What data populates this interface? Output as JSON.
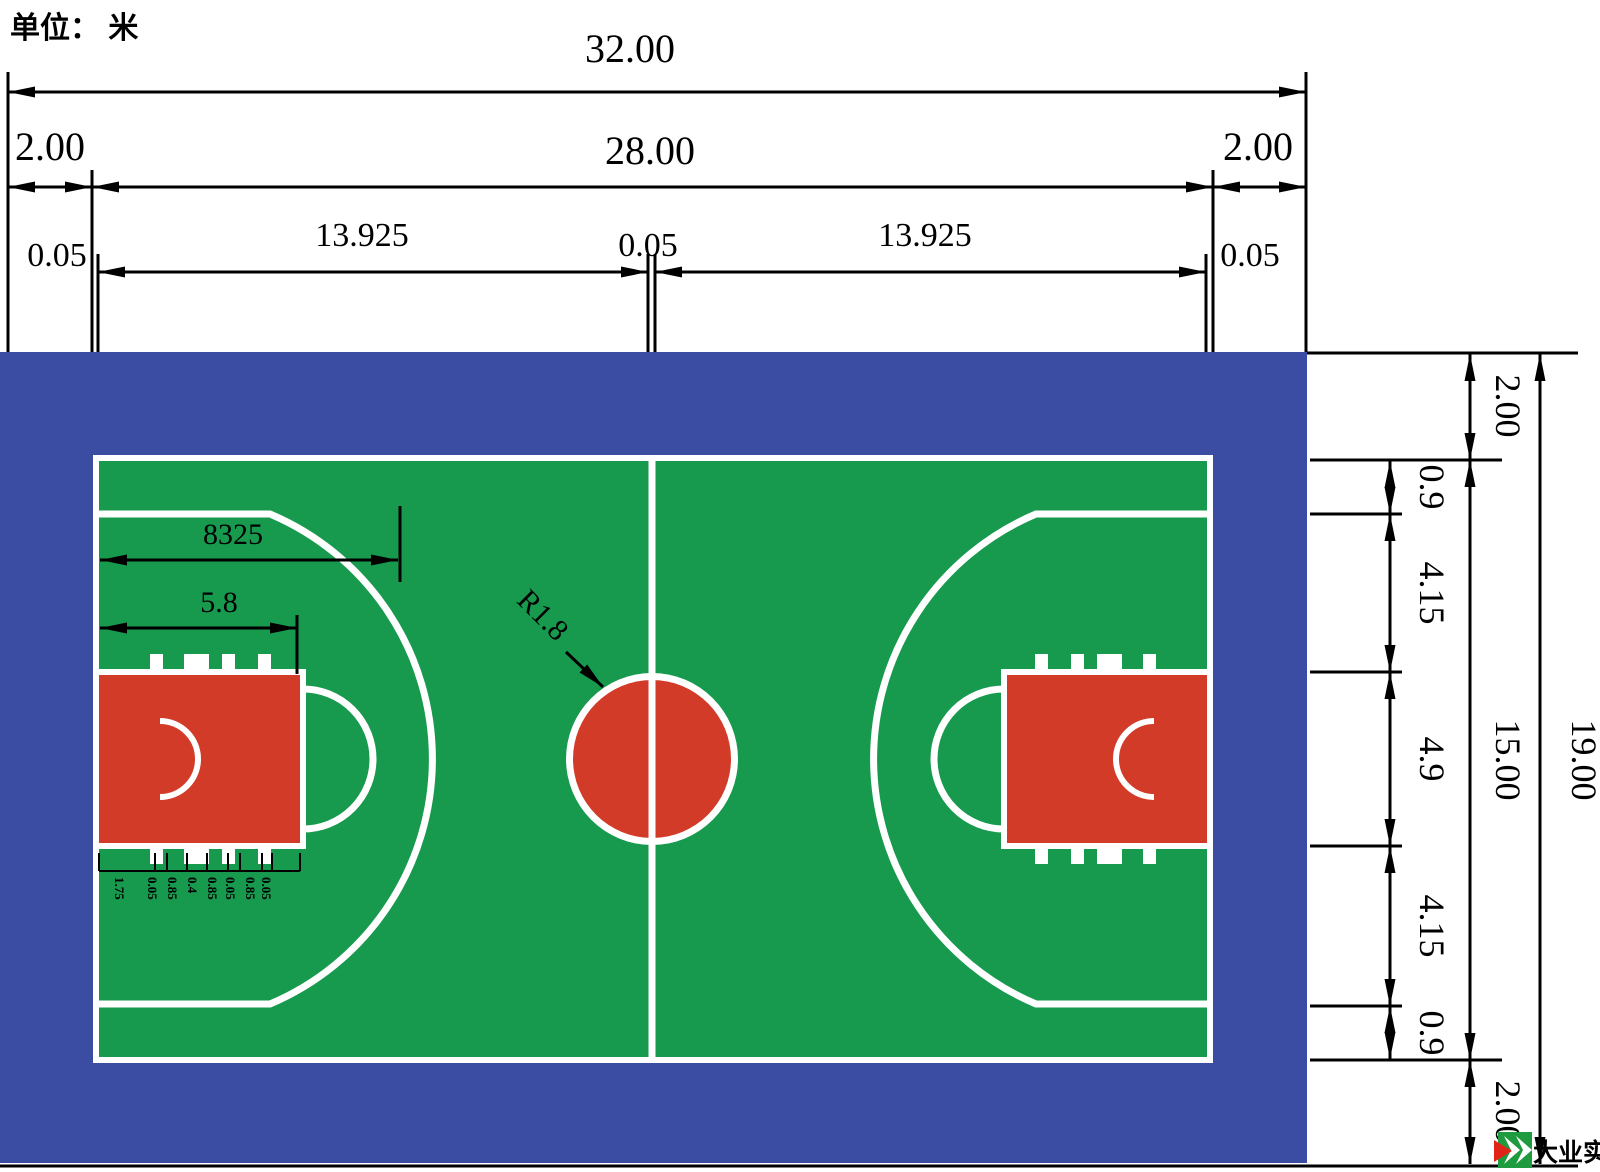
{
  "title": {
    "unit_label": "单位： 米"
  },
  "colors": {
    "apron_blue": "#3B4DA2",
    "court_green": "#17994E",
    "marking_red": "#D23B28",
    "line_white": "#FFFFFF",
    "dim_black": "#000000"
  },
  "dims": {
    "total_width": "32.00",
    "buffer_left": "2.00",
    "court_length": "28.00",
    "buffer_right": "2.00",
    "sideline_width_left": "0.05",
    "half_court_left": "13.925",
    "center_line_width": "0.05",
    "half_court_right": "13.925",
    "sideline_width_right": "0.05",
    "three_point_length": "8325",
    "free_throw_distance": "5.8",
    "center_circle_radius": "R1.8",
    "buffer_top": "2.00",
    "sideline_to_three_point_top": "0.9",
    "three_point_to_key_top": "4.15",
    "key_width": "4.9",
    "key_to_three_point_bottom": "4.15",
    "three_point_to_sideline_bottom": "0.9",
    "buffer_bottom": "2.00",
    "court_width": "15.00",
    "total_height": "19.00",
    "lane_chain": [
      "1.75",
      "0.05",
      "0.85",
      "0.4",
      "0.85",
      "0.05",
      "0.85",
      "0.05"
    ]
  },
  "logo": {
    "name": "大业实业"
  }
}
